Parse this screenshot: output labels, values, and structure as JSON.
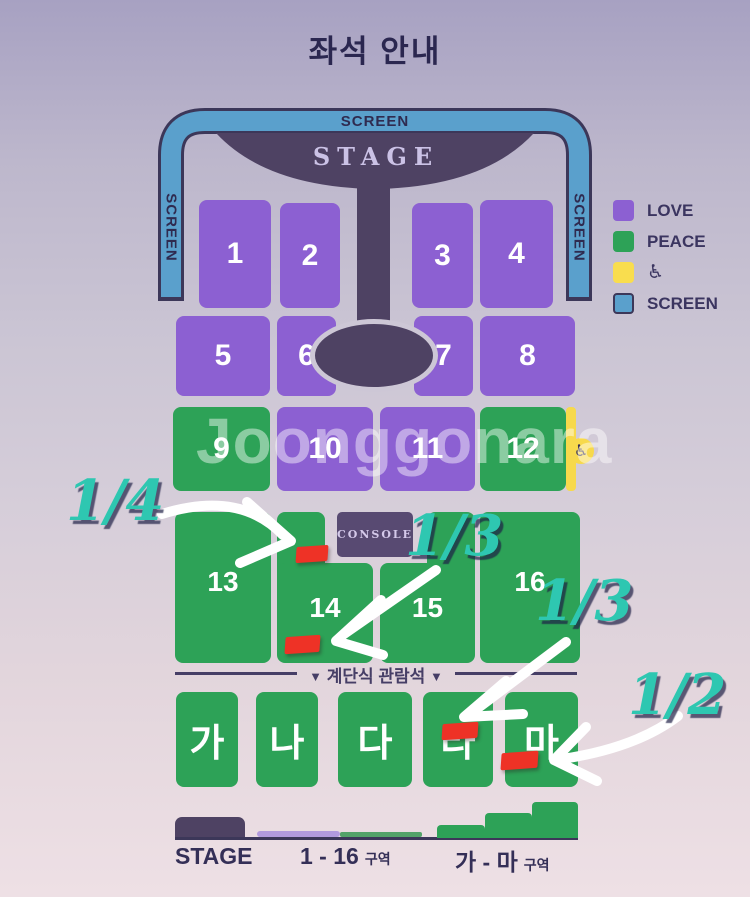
{
  "title": "좌석 안내",
  "screen": {
    "top": "SCREEN",
    "left": "SCREEN",
    "right": "SCREEN"
  },
  "stage_label": "STAGE",
  "console_label": "CONSOLE",
  "sections": {
    "row1": [
      "1",
      "2",
      "3",
      "4"
    ],
    "row2": [
      "5",
      "6",
      "7",
      "8"
    ],
    "row3": [
      "9",
      "10",
      "11",
      "12"
    ],
    "row4": [
      "13",
      "14",
      "15",
      "16"
    ],
    "row5": [
      "가",
      "나",
      "다",
      "라",
      "마"
    ]
  },
  "zones": {
    "love_sections": [
      "1",
      "2",
      "3",
      "4",
      "5",
      "6",
      "7",
      "8",
      "10",
      "11"
    ],
    "peace_sections": [
      "9",
      "12",
      "13",
      "14",
      "15",
      "16",
      "가",
      "나",
      "다",
      "라",
      "마"
    ]
  },
  "wheelchair_icon": "♿",
  "legend": {
    "items": [
      {
        "label": "LOVE",
        "color": "#8c60d2"
      },
      {
        "label": "PEACE",
        "color": "#2da257"
      },
      {
        "label": "♿",
        "color": "#f9dd4e"
      },
      {
        "label": "SCREEN",
        "color": "#5aa0cc"
      }
    ]
  },
  "divider": {
    "marker_left": "▼",
    "label": "계단식 관람석",
    "marker_right": "▼"
  },
  "annotations": [
    {
      "label": "1/4"
    },
    {
      "label": "1/3"
    },
    {
      "label": "1/3"
    },
    {
      "label": "1/2"
    }
  ],
  "bottom_legend": {
    "stage": "STAGE",
    "flat_label": "1 - 16",
    "flat_suffix": "구역",
    "step_label": "가 - 마",
    "step_suffix": "구역"
  },
  "watermark": "Joonggonara",
  "colors": {
    "love": "#8c60d2",
    "peace": "#2da257",
    "screen": "#5aa0cc",
    "wheelchair": "#f9dd4e",
    "stage": "#4e4263",
    "red_mark": "#ee3226",
    "annotation_teal": "#2ec7b1"
  }
}
